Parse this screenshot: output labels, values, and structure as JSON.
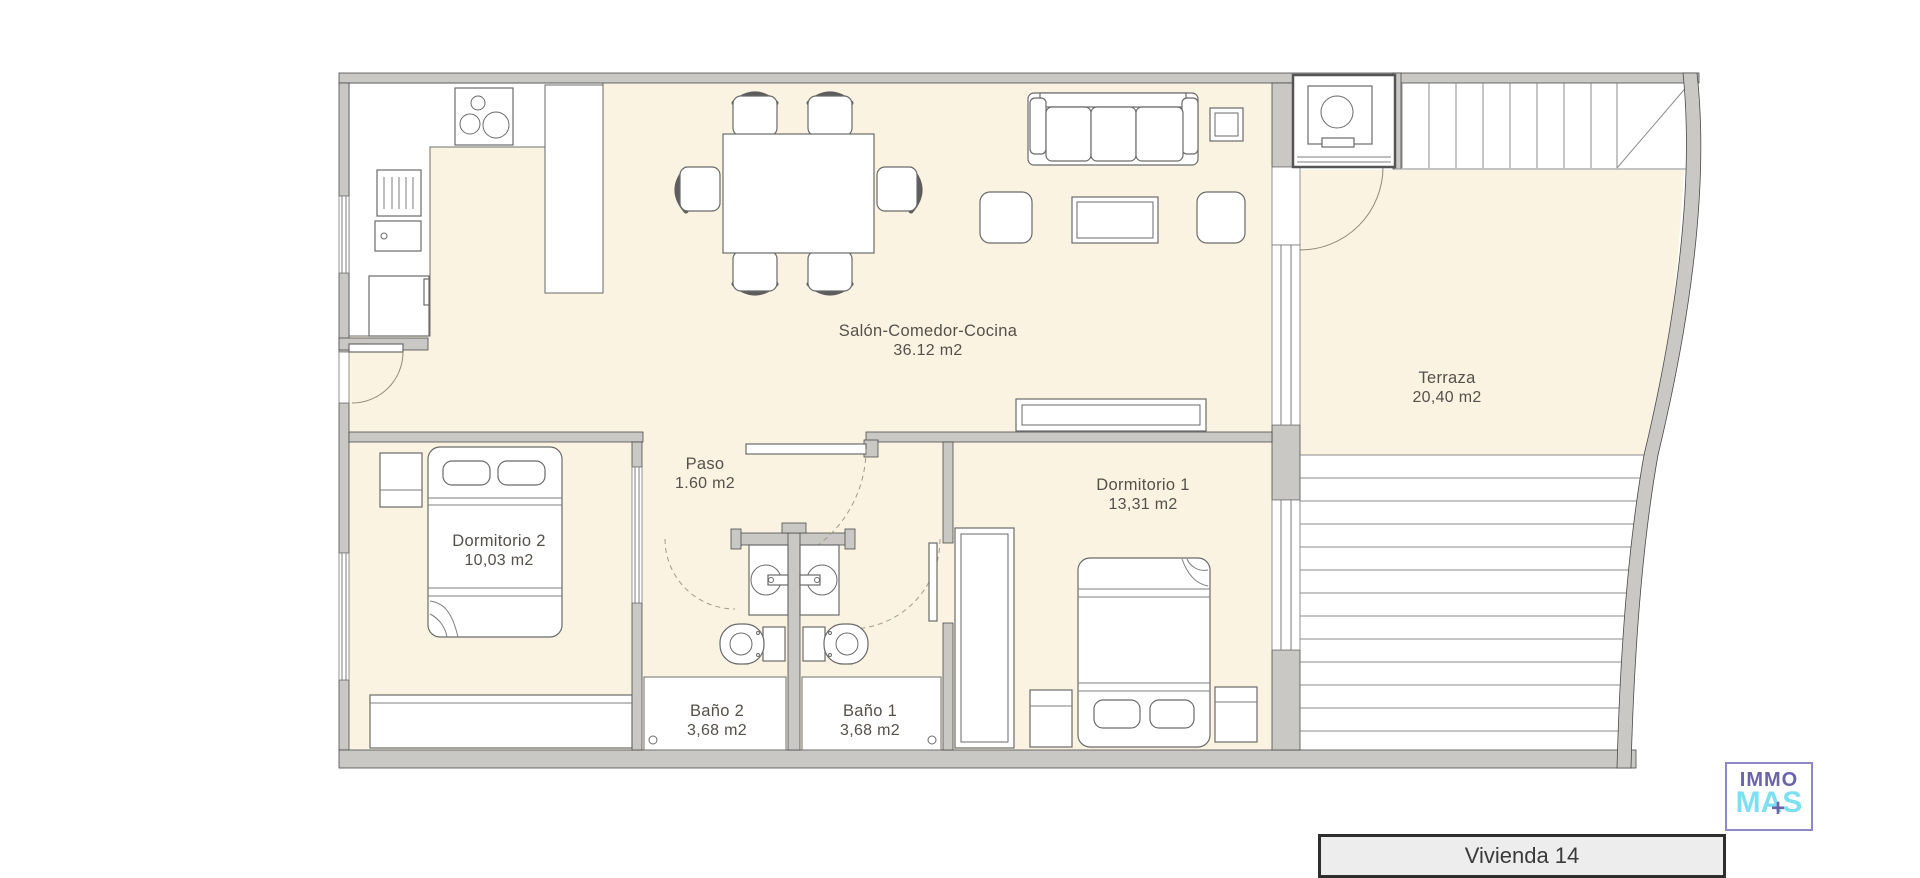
{
  "rooms": {
    "salon": {
      "name": "Salón-Comedor-Cocina",
      "area": "36.12 m2"
    },
    "terraza": {
      "name": "Terraza",
      "area": "20,40 m2"
    },
    "paso": {
      "name": "Paso",
      "area": "1.60 m2"
    },
    "dormitorio1": {
      "name": "Dormitorio 1",
      "area": "13,31 m2"
    },
    "dormitorio2": {
      "name": "Dormitorio 2",
      "area": "10,03 m2"
    },
    "bano2": {
      "name": "Baño 2",
      "area": "3,68 m2"
    },
    "bano1": {
      "name": "Baño 1",
      "area": "3,68 m2"
    }
  },
  "unit_box": {
    "label": "Vivienda 14"
  },
  "logo": {
    "top": "IMMO",
    "bottom": "MAS",
    "plus": "+"
  },
  "colors": {
    "floor": "#FBF3E2",
    "wall": "#C9C8C5",
    "outline": "#4A4A4A",
    "label_text": "#55504A",
    "logo_purple": "#6B64AB",
    "logo_cyan": "#7EDFF2",
    "unit_box_fill": "#EDEDED"
  }
}
